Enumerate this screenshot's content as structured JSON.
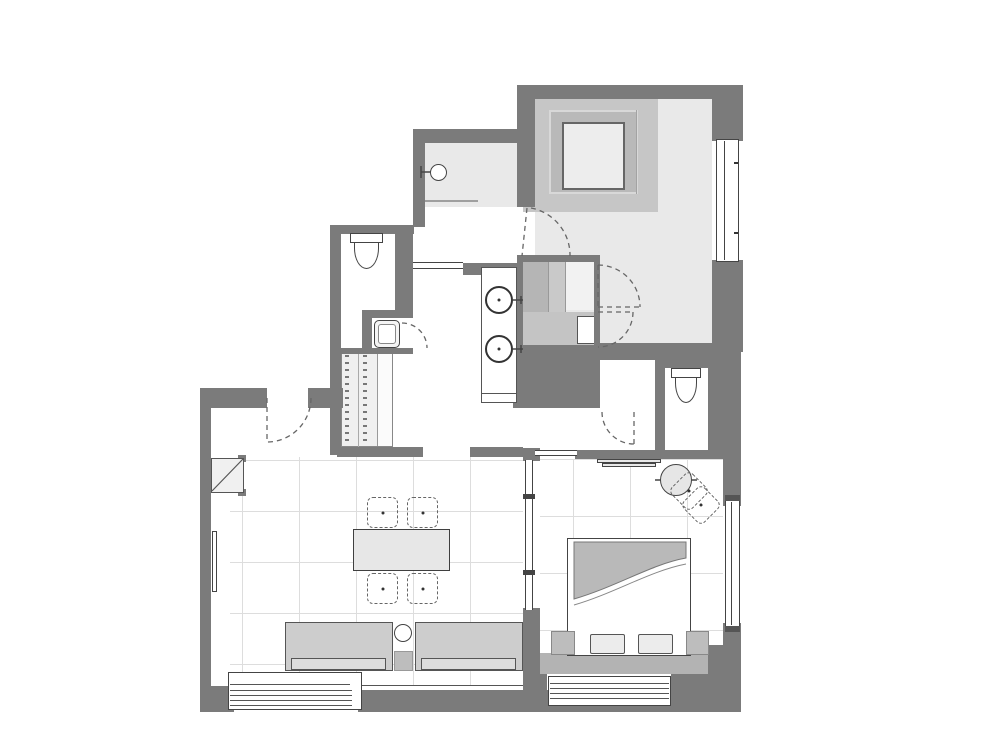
{
  "meta": {
    "type": "architectural-floor-plan",
    "visible_text": "none"
  },
  "colors": {
    "wall": "#7b7b7b",
    "floor_light": "#e9e9e9",
    "floor_white": "#ffffff",
    "platform": "#c6c6c6",
    "platform_ring": "#b9b9b9",
    "platform_inner": "#ededed",
    "furniture": "#cdcdcd",
    "seat": "#dddddd",
    "ledge": "#b3b3b3",
    "panel": "#b5b5b5",
    "panel_light": "#c9c9c9",
    "grid": "#dddddd",
    "line": "#3f3f3f",
    "dash": "#666666",
    "glass": "#9f9f9f"
  },
  "fixtures": [
    {
      "name": "shower-head-icon",
      "shape": "circle-with-wall-arm",
      "count": 1
    },
    {
      "name": "toilet-icon",
      "shape": "tank-and-bowl",
      "count": 2
    },
    {
      "name": "washbasin-icon",
      "shape": "circle-with-tap",
      "count": 2
    },
    {
      "name": "small-basin-icon",
      "shape": "rounded-square",
      "count": 1
    },
    {
      "name": "dining-table",
      "shape": "rectangle",
      "count": 1
    },
    {
      "name": "dining-chair",
      "shape": "dashed-rounded-square-with-dot",
      "count": 4
    },
    {
      "name": "sofa-module",
      "shape": "rectangle-with-seat-line",
      "count": 2
    },
    {
      "name": "sofa-side-table",
      "shape": "small-circle",
      "count": 1
    },
    {
      "name": "double-bed",
      "shape": "frame-with-duvet-wave-and-pillows",
      "count": 1
    },
    {
      "name": "pillow",
      "shape": "small-rounded-rectangle",
      "count": 2
    },
    {
      "name": "nightstand",
      "shape": "gray-square",
      "count": 2
    },
    {
      "name": "round-side-table",
      "shape": "circle-with-ticks",
      "count": 1
    },
    {
      "name": "rotated-chair",
      "shape": "dashed-square-rotated-45",
      "count": 2
    },
    {
      "name": "tatami-platform",
      "shape": "nested-squares",
      "count": 1
    },
    {
      "name": "wardrobe",
      "shape": "paneled-closet",
      "count": 1
    },
    {
      "name": "shelf-closet",
      "shape": "double-tick-columns",
      "count": 1
    },
    {
      "name": "wall-shelf",
      "shape": "thin-double-bar",
      "count": 1
    },
    {
      "name": "radiator",
      "shape": "thin-vertical-bar",
      "count": 1
    },
    {
      "name": "service-shaft",
      "shape": "box-with-diagonal",
      "count": 1
    },
    {
      "name": "door-swing",
      "shape": "dashed-quarter-arc",
      "count": 6
    },
    {
      "name": "window",
      "shape": "framed-glazing",
      "count": 4
    }
  ]
}
